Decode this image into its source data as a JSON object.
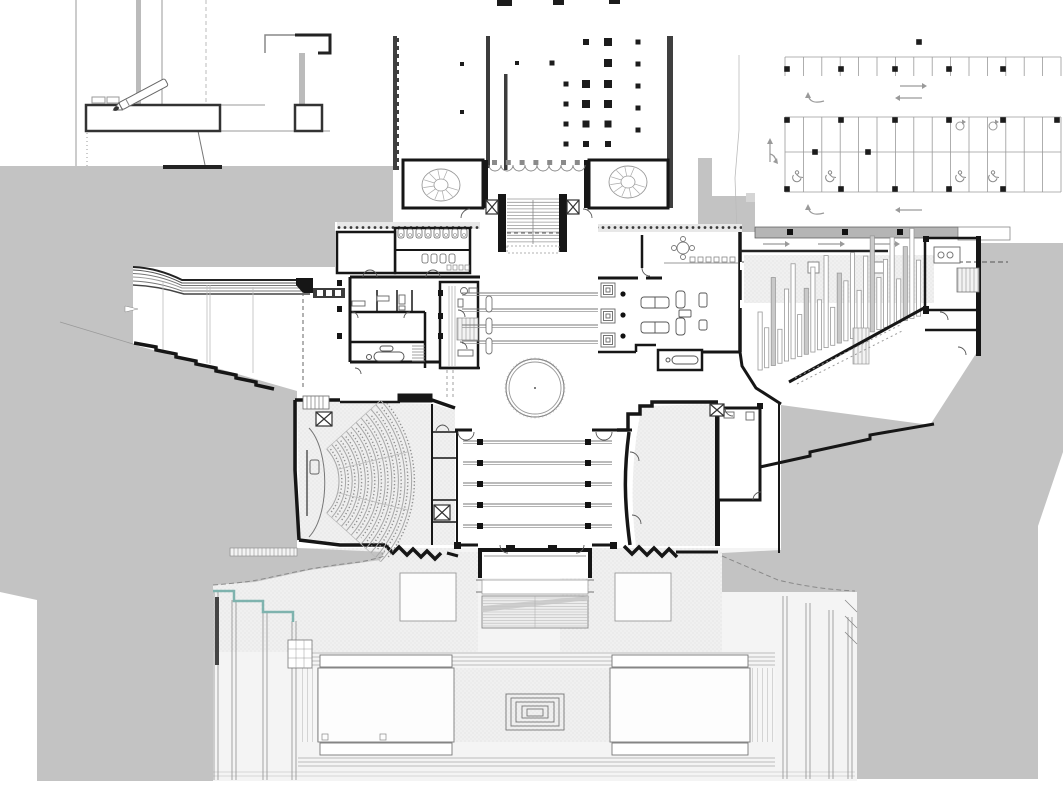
{
  "diagram": {
    "type": "architectural-site-plan",
    "colors": {
      "poche_gray": "#c3c3c3",
      "canopy_gray": "#b5b5b5",
      "wall_black": "#161616",
      "wall_dark": "#3c3c3c",
      "line_mid": "#8a8a8a",
      "line_light": "#bdbdbd",
      "stipple_bg": "#f0f0f0",
      "stipple_dot": "#d8d8d8",
      "teal_accent": "#7fb3ae",
      "white": "#ffffff"
    },
    "existing_hall": {
      "columns": [
        [
          462,
          64,
          4
        ],
        [
          462,
          112,
          4
        ],
        [
          517,
          63,
          4
        ],
        [
          552,
          63,
          5
        ],
        [
          566,
          84,
          5
        ],
        [
          566,
          104,
          5
        ],
        [
          566,
          124,
          5
        ],
        [
          566,
          144,
          5
        ],
        [
          586,
          42,
          6
        ],
        [
          586,
          84,
          8
        ],
        [
          586,
          104,
          8
        ],
        [
          586,
          124,
          7
        ],
        [
          586,
          144,
          6
        ],
        [
          608,
          42,
          8
        ],
        [
          608,
          63,
          8
        ],
        [
          608,
          84,
          8
        ],
        [
          608,
          104,
          8
        ],
        [
          608,
          124,
          7
        ],
        [
          608,
          144,
          6
        ],
        [
          638,
          42,
          5
        ],
        [
          638,
          64,
          5
        ],
        [
          638,
          86,
          5
        ],
        [
          638,
          108,
          5
        ],
        [
          638,
          130,
          5
        ]
      ],
      "top_marks": [
        [
          497,
          0,
          15,
          6
        ],
        [
          553,
          0,
          11,
          5
        ],
        [
          609,
          0,
          11,
          4
        ]
      ]
    },
    "parking": {
      "top_row": {
        "x0": 785,
        "x1": 1061,
        "y0": 57,
        "y1": 76,
        "step": 18.4
      },
      "mid_block": {
        "x0": 785,
        "x1": 1061,
        "y0": 117,
        "y_mid": 152,
        "y1": 192,
        "step": 18.4
      },
      "squares": [
        [
          787,
          69
        ],
        [
          841,
          69
        ],
        [
          895,
          69
        ],
        [
          949,
          69
        ],
        [
          1003,
          69
        ],
        [
          919,
          42
        ],
        [
          787,
          120
        ],
        [
          841,
          120
        ],
        [
          895,
          120
        ],
        [
          949,
          120
        ],
        [
          1003,
          120
        ],
        [
          1057,
          120
        ],
        [
          787,
          189
        ],
        [
          841,
          189
        ],
        [
          895,
          189
        ],
        [
          949,
          189
        ],
        [
          1003,
          189
        ],
        [
          815,
          152
        ],
        [
          868,
          152
        ]
      ],
      "accessible_stalls": [
        [
          797,
          177
        ],
        [
          830,
          177
        ],
        [
          960,
          177
        ],
        [
          993,
          177
        ]
      ],
      "turn_symbols": [
        [
          960,
          126
        ],
        [
          993,
          126
        ]
      ],
      "straight_arrows": [
        [
          900,
          86,
          922,
          86
        ],
        [
          922,
          98,
          900,
          98
        ],
        [
          922,
          210,
          900,
          210
        ],
        [
          763,
          244,
          785,
          244
        ],
        [
          818,
          244,
          840,
          244
        ],
        [
          873,
          244,
          895,
          244
        ]
      ],
      "curved_arrows": [
        [
          816,
          97
        ],
        [
          816,
          209
        ]
      ],
      "up_arrow": [
        770,
        152
      ]
    },
    "gallery_tracks": {
      "ys": [
        293,
        309,
        325,
        341
      ],
      "x0": 462,
      "x1": 598,
      "benches": [
        [
          489,
          296
        ],
        [
          489,
          318
        ],
        [
          489,
          338
        ]
      ]
    },
    "central_tracks": {
      "ys": [
        441,
        462,
        483,
        504,
        525
      ],
      "x0": 463,
      "x1": 612,
      "square_xs": [
        480,
        588
      ]
    },
    "lounge": {
      "skylight_x": 601,
      "skylight_ys": [
        283,
        309,
        333
      ],
      "column_dots": [
        [
          623,
          294
        ],
        [
          623,
          315
        ],
        [
          623,
          336
        ]
      ],
      "chair_xs": [
        690,
        698,
        706,
        714,
        722,
        730
      ],
      "chair_y": 257
    },
    "ramp_gallery": {
      "x0": 758,
      "step": 6.6,
      "base_y": 370,
      "slope": 0.34,
      "heights": [
        58,
        40,
        88,
        34,
        72,
        95,
        42,
        66,
        85,
        50,
        92,
        38,
        70,
        60,
        86,
        46,
        78,
        96,
        52,
        68,
        88,
        44,
        74,
        90,
        56
      ]
    },
    "auditorium": {
      "cx": 291,
      "cy": 481,
      "r0": 48,
      "dr": 6.6,
      "rows": 12,
      "a0": -42,
      "a1": 42,
      "aisles": [
        -42,
        -14,
        14,
        42
      ]
    },
    "rotunda": {
      "cx": 535,
      "cy": 388,
      "r_outer": 29,
      "r_inner": 26,
      "ticks": 48
    },
    "grand_stair": {
      "x0": 507,
      "x1": 559,
      "y0": 199,
      "y1": 245,
      "step": 3.3
    },
    "spiral_stairs": [
      {
        "cx": 441,
        "cy": 185,
        "rx": 19,
        "ry": 16
      },
      {
        "cx": 628,
        "cy": 182,
        "rx": 19,
        "ry": 16
      }
    ],
    "arcade": {
      "x0": 489,
      "x1": 585,
      "y": 165,
      "r": 6
    },
    "toilets": {
      "stall_xs": [
        398,
        407,
        416,
        425,
        434,
        443,
        452,
        461
      ],
      "stall_y": 229,
      "row2_xs": [
        422,
        431,
        440,
        449
      ],
      "row2_y": 254,
      "sink_xs": [
        447,
        453,
        459,
        465
      ],
      "sink_y": 265
    },
    "terraces": {
      "left_xs": [
        214,
        218,
        232,
        236,
        263,
        267,
        292,
        296
      ],
      "left_tops": [
        591,
        591,
        600,
        600,
        611,
        611,
        621,
        621
      ],
      "left_bottom": 780,
      "right_xs": [
        783,
        787,
        806,
        810,
        829,
        833,
        848,
        852
      ],
      "right_tops": [
        596,
        596,
        603,
        603,
        610,
        610,
        617,
        617
      ],
      "right_bottom": 779
    },
    "fountain": {
      "rings": [
        [
          506,
          694,
          58,
          36
        ],
        [
          511,
          698,
          48,
          28
        ],
        [
          516,
          702,
          38,
          20
        ],
        [
          522,
          706,
          26,
          12
        ],
        [
          527,
          709,
          16,
          7
        ]
      ]
    },
    "courtyard": {
      "x0": 298,
      "x1": 775,
      "top_band_ys": [
        653,
        657,
        661,
        665
      ],
      "bottom_band_ys": [
        758,
        762,
        766
      ],
      "edge_ys": [
        772,
        776
      ]
    },
    "ramp": {
      "x0": 482,
      "x1": 588,
      "y0": 598,
      "y1": 626,
      "step": 2.8
    }
  }
}
